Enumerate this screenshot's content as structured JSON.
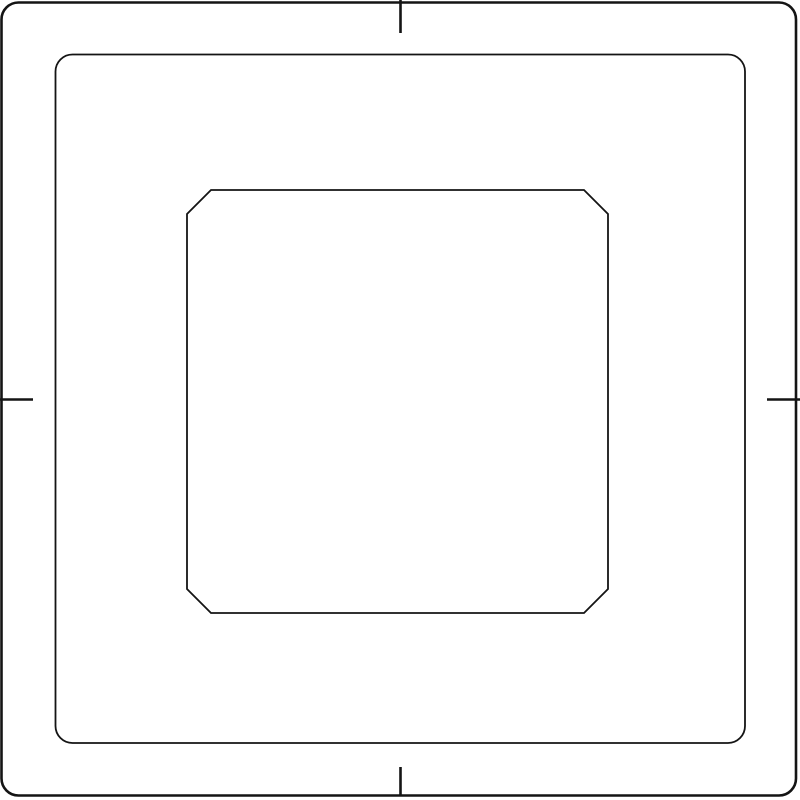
{
  "title": "Nested square stencil with chamfered center plate and registration ticks",
  "canvas": {
    "width": 800,
    "height": 800,
    "background_color": "#ffffff",
    "line_color": "#141414"
  },
  "shapes": {
    "outer_frame": {
      "x": 1.5,
      "y": 2.5,
      "width": 794.5,
      "height": 793,
      "corner_radius": 17,
      "stroke_width": 2.6
    },
    "inner_frame": {
      "x": 55.5,
      "y": 54.5,
      "width": 689.5,
      "height": 688.5,
      "corner_radius": 17,
      "stroke_width": 1.8
    },
    "center_plate": {
      "points": "211,190 584,190 608,214 608,589 584,613 211,613 187,589 187,214",
      "chamfer": 24,
      "stroke_width": 1.8
    },
    "ticks": {
      "stroke_width": 2.6,
      "top": {
        "x1": 400.5,
        "y1": 0,
        "x2": 400.5,
        "y2": 33
      },
      "bottom": {
        "x1": 400.5,
        "y1": 767,
        "x2": 400.5,
        "y2": 796
      },
      "left": {
        "x1": 0,
        "y1": 399.5,
        "x2": 33,
        "y2": 399.5
      },
      "right": {
        "x1": 767,
        "y1": 399.5,
        "x2": 800,
        "y2": 399.5
      }
    }
  }
}
